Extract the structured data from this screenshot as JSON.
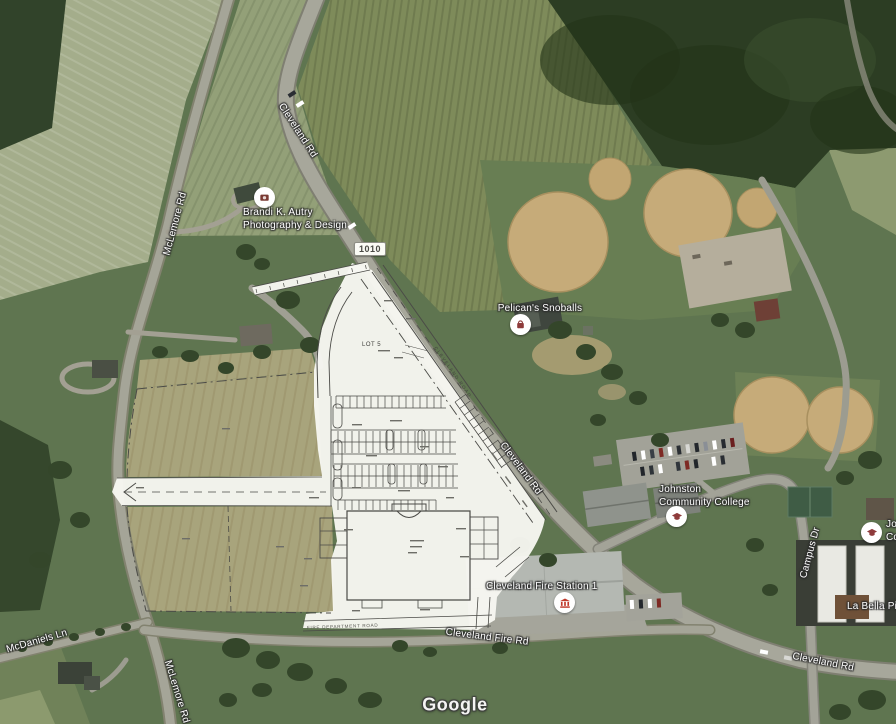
{
  "map": {
    "watermark": "Google",
    "route_shield": "1010"
  },
  "pois": [
    {
      "line1": "Brandi K. Autry",
      "line2": "Photography & Design",
      "icon": "camera-icon"
    },
    {
      "line1": "Pelican's Snoballs",
      "icon": "shop-icon"
    },
    {
      "line1": "Johnston",
      "line2": "Community College",
      "icon": "school-icon"
    },
    {
      "line1": "Cleveland Fire Station 1",
      "icon": "institution-icon"
    },
    {
      "line1": "La Bella Pizza"
    },
    {
      "line1": "Johnston",
      "line2": "College",
      "icon": "school-icon"
    }
  ],
  "roads": [
    {
      "label": "Cleveland Rd"
    },
    {
      "label": "McLemore Rd"
    },
    {
      "label": "Cleveland Rd"
    },
    {
      "label": "Campus Dr"
    },
    {
      "label": "Cleveland Fire Rd"
    },
    {
      "label": "McDaniels Ln"
    },
    {
      "label": "McLemore Rd"
    },
    {
      "label": "Cleveland Rd"
    }
  ],
  "site_plan": {
    "lot_label": "LOT 5",
    "road_label": "CLEVELAND ROAD",
    "access_road_label": "FIRE DEPARTMENT ROAD"
  },
  "colors": {
    "poi_icon_red": "#8e3b3b",
    "fire_icon_red": "#c0392b",
    "label_text": "#ffffff",
    "plan_paper": "#f7f7f1",
    "plan_line": "#4b4b47"
  }
}
